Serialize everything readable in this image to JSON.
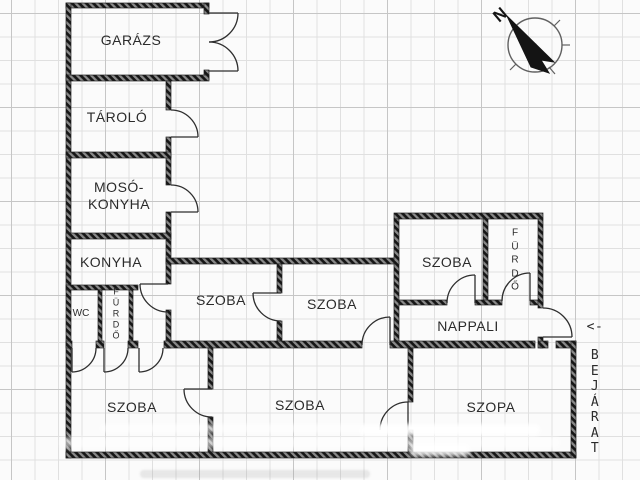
{
  "rooms": {
    "garazs": {
      "label": "GARÁZS"
    },
    "tarolo": {
      "label": "TÁROLÓ"
    },
    "moso_konyha": {
      "line1": "MOSÓ-",
      "line2": "KONYHA"
    },
    "konyha": {
      "label": "KONYHA"
    },
    "wc": {
      "label": "WC"
    },
    "furdo_small": {
      "label": "FÜRDŐ",
      "stacked": "F\nÜ\nR\nD\nŐ"
    },
    "szoba_mid_left": {
      "label": "SZOBA"
    },
    "szoba_mid_center": {
      "label": "SZOBA"
    },
    "szoba_top_right": {
      "label": "SZOBA"
    },
    "furdo_top_right": {
      "label": "FÜRDŐ",
      "stacked": "F\nÜ\nR\nD\nŐ"
    },
    "nappali": {
      "label": "NAPPALI"
    },
    "szoba_bottom_left": {
      "label": "SZOBA"
    },
    "szoba_bottom_center": {
      "label": "SZOBA"
    },
    "szoba_bottom_right": {
      "label": "SZOPA"
    }
  },
  "entrance": {
    "arrow": "<-",
    "label": "BEJÁRAT",
    "stacked": "B\nE\nJ\nÁ\nR\nA\nT"
  },
  "compass": {
    "letter": "N"
  },
  "colors": {
    "wall": "#1f1f1f",
    "wall_hatch_light": "#808080",
    "text": "#2b2b2b",
    "grid_minor": "#e0e0e0",
    "grid_major": "#c6c6c6",
    "background": "#fbfbfb"
  }
}
